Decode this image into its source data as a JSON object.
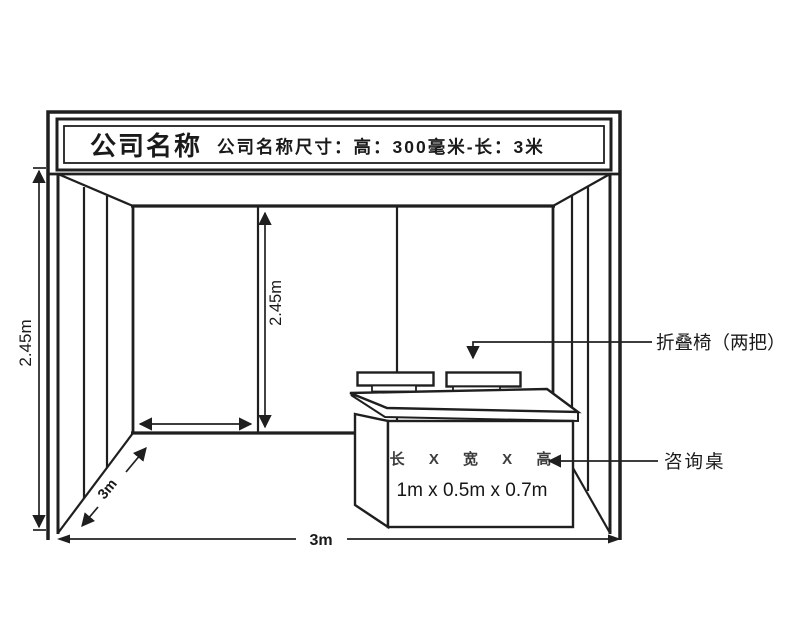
{
  "banner": {
    "company_name": "公司名称",
    "size_note": "公司名称尺寸：高：300毫米-长：3米"
  },
  "dimensions": {
    "wall_height_outer": "2.45m",
    "wall_height_inner": "2.45m",
    "booth_depth": "3m",
    "booth_width": "3m"
  },
  "desk": {
    "dims_header": "长 X 宽 X 高",
    "dims_value": "1m x 0.5m x 0.7m"
  },
  "annotations": {
    "chairs": "折叠椅（两把）",
    "desk": "咨询桌"
  },
  "colors": {
    "line": "#1f1f1f",
    "background": "#ffffff"
  }
}
